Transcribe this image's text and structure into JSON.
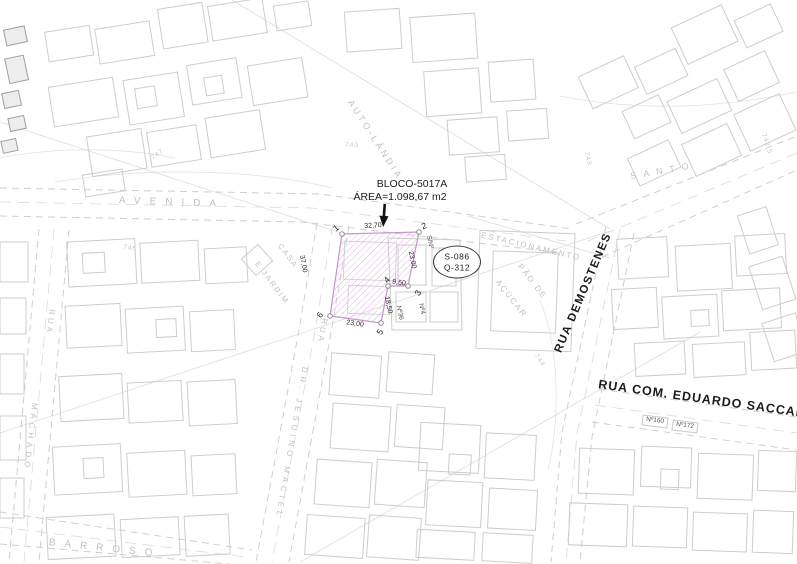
{
  "lot": {
    "title": "BLOCO-5017A",
    "area": "ÁREA=1.098,67 m2",
    "badge": {
      "line1": "S-086",
      "line2": "Q-312"
    },
    "vertices": {
      "v1": "1",
      "v2": "2",
      "v3": "3",
      "v4": "4",
      "v5": "5",
      "v6": "6"
    },
    "dims": {
      "top": "32,70",
      "right": "23,00",
      "notch": "9,50",
      "inner": "18,50",
      "bottom": "23,00",
      "left": "37,00"
    }
  },
  "streets": {
    "avenida": "AVENIDA",
    "demostenes": "RUA DEMOSTENES",
    "saccab": "RUA COM. EDUARDO SACCAB",
    "machado_prefix": "RUA",
    "machado": "MACHADO",
    "jesuino_prefix": "RUA",
    "jesuino": "DR. JESUINO MACIEL",
    "barroso": "BARROSO",
    "santo": "SANTO",
    "autolandia": "AUTO-LÂNDIA"
  },
  "places": {
    "estacionamento": "ESTACIONAMENTO",
    "pao_de": "PÃO DE",
    "acucar": "AÇÚCAR",
    "casa": "CASA",
    "e_jardim": "E JARDIM"
  },
  "addresses": {
    "sn": "S/Nº",
    "n4": "Nº4",
    "n36": "Nº36",
    "n160": "Nº160",
    "n172": "Nº172"
  },
  "contours": {
    "c747": "747",
    "c745": "745",
    "c740": "740",
    "c743": "743",
    "c742_5": "742,5",
    "c744": "744"
  },
  "colors": {
    "lot_hatch": "#dfa9df",
    "lot_outline": "#c993cb",
    "linework": "#cdcdcd",
    "text_dark": "#1b1b1b",
    "text_light": "#c1c1c1"
  }
}
